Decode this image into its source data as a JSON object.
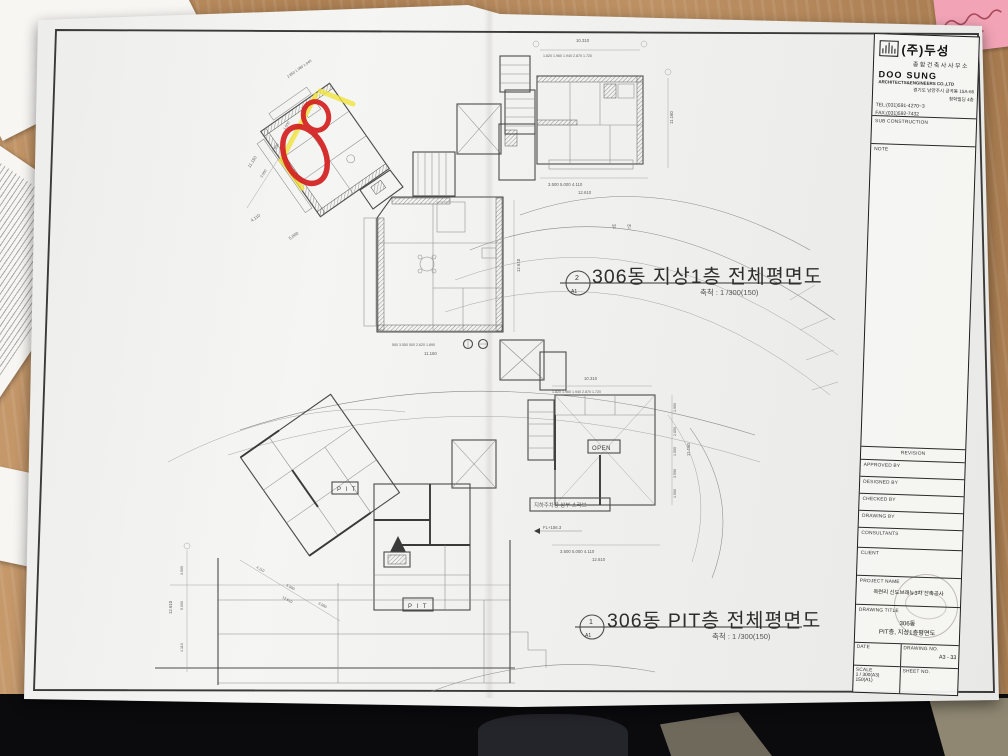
{
  "colors": {
    "wood": "#b3855a",
    "paper": "#f2f2f0",
    "pen_red": "#d31f1f",
    "highlight_yellow": "#f2e43c",
    "sticky_pink": "#f2a4b6"
  },
  "sheet": {
    "plan1": {
      "title": "306동 지상1층 전체평면도",
      "scale_note": "축척 : 1 /300(150)",
      "marker_no": "2",
      "marker_sheet": "A1"
    },
    "plan2": {
      "title": "306동 PIT층 전체평면도",
      "scale_note": "축척 : 1 /300(150)",
      "marker_no": "1",
      "marker_sheet": "A1"
    },
    "labels": {
      "pit1": "P I T",
      "pit2": "P I T",
      "open": "OPEN",
      "slab": "지하주차장 상부 스라브",
      "level": "FL+156.3",
      "slope": "법  면"
    },
    "dims": {
      "t1": "10.310",
      "t1segs": "1.820 1.960 1.940 2.870 1.720",
      "t1b": "3.500       5.000       4.110",
      "t1btotal": "12.610",
      "t1side": "11.160",
      "c1segs": "500 3.550 500 2.620 1.890",
      "c1total": "11.160",
      "c1side": "12.610",
      "tl_top": "2.850 1.980 1.940",
      "tl_s1": "3.550",
      "tl_s2": "2.950",
      "tl_s3": "1.500",
      "tl_side": "11.150",
      "tl_b1": "4.110",
      "tl_b2": "5.000",
      "b1": "10.310",
      "b1segs": "1.820 1.960 1.940 2.870 1.720",
      "br_r1": "1.950",
      "br_r2": "2.850",
      "br_r3": "1.500",
      "br_r4": "3.590",
      "br_r5": "1.500",
      "br_rtotal": "11.160",
      "br_b": "3.500       5.000       4.110",
      "br_btotal": "12.610",
      "bl_v1": "3.500",
      "bl_v2": "5.000",
      "bl_v3": "4.110",
      "bl_vtotal": "12.610",
      "bl_d1": "4.110",
      "bl_d2": "5.000",
      "bl_d3": "3.500",
      "bl_dtotal": "12.610"
    },
    "title_block": {
      "company_name": "(주)두성",
      "company_type": "종합건축사사무소",
      "company_en": "DOO SUNG",
      "company_en_sub": "ARCHITECTS&ENGINEERS CO.,LTD",
      "address_line1": "경기도 남양주시 금곡동 15A-66",
      "address_line2": "청학빌딩 4층",
      "tel": "TEL:(031)591-4270~3",
      "fax": "FAX:(031)592-7432",
      "sub_construction": "SUB CONSTRUCTION",
      "note": "NOTE",
      "revision": "REVISION",
      "approved_by": "APPROVED BY",
      "designed_by": "DESIGNED BY",
      "checked_by": "CHECKED BY",
      "drawing_by": "DRAWING BY",
      "consultants": "CONSULTANTS",
      "client": "CLIENT",
      "project_name_label": "PROJECT NAME",
      "project_name": "옥련리 신도브래뉴3차 신축공사",
      "drawing_title_label": "DRAWING TITLE",
      "drawing_title_line1": "306동",
      "drawing_title_line2": "PIT층, 지상1층평면도",
      "date_label": "DATE",
      "drawing_no_label": "DRAWING NO.",
      "drawing_no": "A3 - 33",
      "scale_label": "SCALE",
      "scale_value1": "1 / 300(A3)",
      "scale_value2": "150(A1)",
      "sheet_no_label": "SHEET NO."
    }
  }
}
